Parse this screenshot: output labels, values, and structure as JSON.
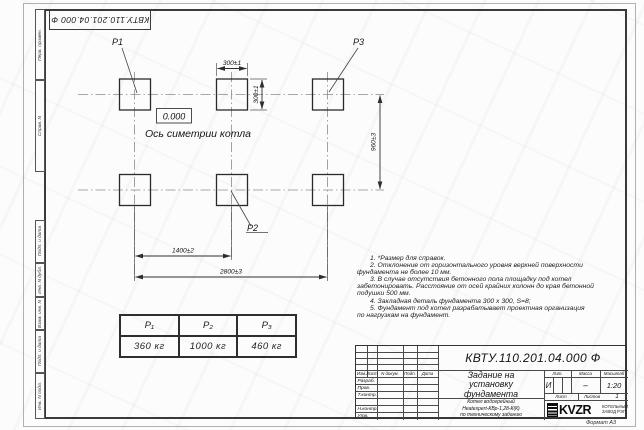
{
  "stamp": {
    "number": "КВТУ.110.201.04.000  Ф"
  },
  "margins": {
    "top_cells": [
      "Перв. примен.",
      "Справ. N"
    ],
    "bottom_cells": [
      "Подп. и дата",
      "Инв. N дубл.",
      "Взам. инв. N",
      "Подп. и дата",
      "Инв. N подл."
    ]
  },
  "drawing": {
    "labels": {
      "p1": "P1",
      "p2": "P2",
      "p3": "P3",
      "zero_level": "0.000",
      "axis": "Ось симетрии котла"
    },
    "dimensions": {
      "pad_width": "300±1",
      "pad_height": "300±1",
      "row_spacing": "960±3",
      "col_spacing": "1400±2",
      "total_length": "2800±3"
    }
  },
  "notes": {
    "lines": [
      "1. *Размер для справок.",
      "2. Отклонение от горизонтального уровня верхней поверхности",
      "фундамента не более 10 мм.",
      "3. В случае отсутствия бетонного пола площадку под котел",
      "забетонировать. Расстояние от осей крайних колонн до края бетонной",
      "подушки 500 мм.",
      "4. Закладная деталь фундамента  300 х 300,  S=8;",
      "5. Фундамент под котел разрабатывает проектная организация",
      "по нагрузкам на фундамент."
    ]
  },
  "load_table": {
    "headers": [
      "P₁",
      "P₂",
      "P₃"
    ],
    "values": [
      "360 кг",
      "1000 кг",
      "460 кг"
    ]
  },
  "title_block": {
    "doc_number": "КВТУ.110.201.04.000  Ф",
    "title_lines": [
      "Задание на",
      "установку",
      "фундамента"
    ],
    "subtitle_lines": [
      "Котел водогрейный",
      "Heatexpert-КВр-1,28-К(К)",
      "по техническому заданию"
    ],
    "rev_header": [
      "Изм.",
      "Лист",
      "N докум.",
      "Подп.",
      "Дата"
    ],
    "row_labels": [
      "Разраб.",
      "Пров.",
      "Т.контр.",
      "Н.контр.",
      "Утв."
    ],
    "lit_label": "Лит.",
    "mass_label": "Масса",
    "scale_label": "Масштаб",
    "lit_value": "И",
    "mass_value": "–",
    "scale_value": "1:20",
    "sheet_label": "Лист",
    "sheets_label": "Листов",
    "sheets_value": "1",
    "logo_text": "KVZR",
    "company_lines": [
      "КОТЕЛЬНЫЙ",
      "ЗАВОД РЭП"
    ],
    "format_label": "Формат А3"
  },
  "colors": {
    "line": "#3a3a3a",
    "centerline": "#8a8a8a",
    "paper": "#fcfcfd"
  }
}
